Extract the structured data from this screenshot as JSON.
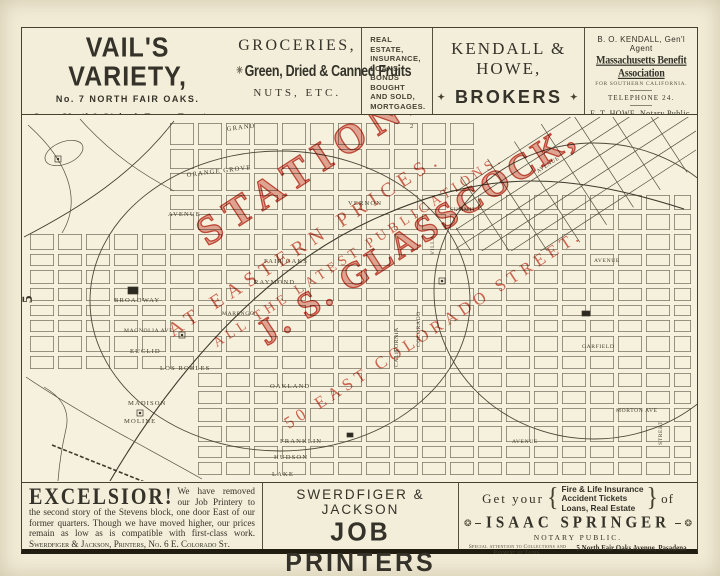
{
  "top_ads": {
    "vails": {
      "title": "VAIL'S VARIETY,",
      "address": "No. 7 NORTH FAIR OAKS.",
      "hours": "Open Until 9 O'clock Every Evening."
    },
    "groceries": {
      "ornament": "✳",
      "line1": "GROCERIES,",
      "line2": "Green, Dried & Canned Fruits",
      "line3": "NUTS, ETC."
    },
    "real_estate": {
      "lines": [
        "REAL ESTATE,",
        "INSURANCE,",
        "LOANS,",
        "BONDS BOUGHT",
        "AND SOLD,",
        "MORTGAGES."
      ],
      "footnote": "CHOICE ORANGE GROVES ANYWHERE IN SOUTHERN CALIFORNIA."
    },
    "kendall_howe": {
      "name": "KENDALL & HOWE,",
      "d_left": "✦",
      "brokers": "BROKERS",
      "d_right": "✦",
      "address": "49 E. Colorado St.",
      "city": "PASADENA, CAL."
    },
    "kendall_agent": {
      "line1": "B. O. KENDALL, Gen'l Agent",
      "line2": "Massachusetts Benefit Association",
      "line3": "FOR SOUTHERN CALIFORNIA.",
      "line4": "TELEPHONE 24.",
      "line5": "E. T. HOWE, Notary Public."
    }
  },
  "map": {
    "streets": [
      "GRAND",
      "ORANGE GROVE",
      "AVENUE",
      "VERNON",
      "SUMMIT",
      "FAIR OAKS",
      "RAYMOND",
      "BROADWAY",
      "MARENGO",
      "MAGNOLIA AVE",
      "EUCLID",
      "LOS ROBLES",
      "OAKLAND",
      "MADISON",
      "MOLINE",
      "FRANKLIN",
      "HUDSON",
      "LAKE",
      "AVENUE",
      "COLORADO",
      "CALIFORNIA",
      "VILLA",
      "STREET",
      "MORTON AVE",
      "GARFIELD",
      "AVENUE",
      "AVENUE"
    ],
    "numerals": {
      "n1": "5",
      "n2": "2"
    },
    "overprint": {
      "line1": "STATIONERY",
      "line2": "AT EASTERN PRICES.",
      "line3": "ALL THE LATEST PUBLICATIONS.",
      "line4": "J. S. GLASSCOCK,",
      "line5": "50 EAST COLORADO STREET."
    }
  },
  "bottom_ads": {
    "excelsior": {
      "headline": "EXCELSIOR!",
      "body": "We have removed our Job Printery to the second story of the Stevens block, one door East of our former quarters. Though we have moved higher, our prices remain as low as is compatible with first-class work.",
      "signature": "Swerdfiger & Jackson, Printers, No. 6 E. Colorado St."
    },
    "printers": {
      "line1": "SWERDFIGER & JACKSON",
      "line2": "JOB PRINTERS",
      "line3": "6 E. Colorado St., Pasadena."
    },
    "springer": {
      "get_your": "Get your",
      "brace_l": "{",
      "services": [
        "Fire & Life Insurance",
        "Accident Tickets",
        "Loans,  Real Estate"
      ],
      "brace_r": "}",
      "of": "of",
      "orn": "❂",
      "name": "ISAAC SPRINGER",
      "title": "NOTARY PUBLIC.",
      "note": "Special attention to Collections and Payment of Taxes.",
      "address": "5 North Fair Oaks Avenue, Pasadena"
    }
  },
  "colors": {
    "paper": "#f2ecd7",
    "ink": "#35322a",
    "overprint_red": "#c53f2d"
  }
}
